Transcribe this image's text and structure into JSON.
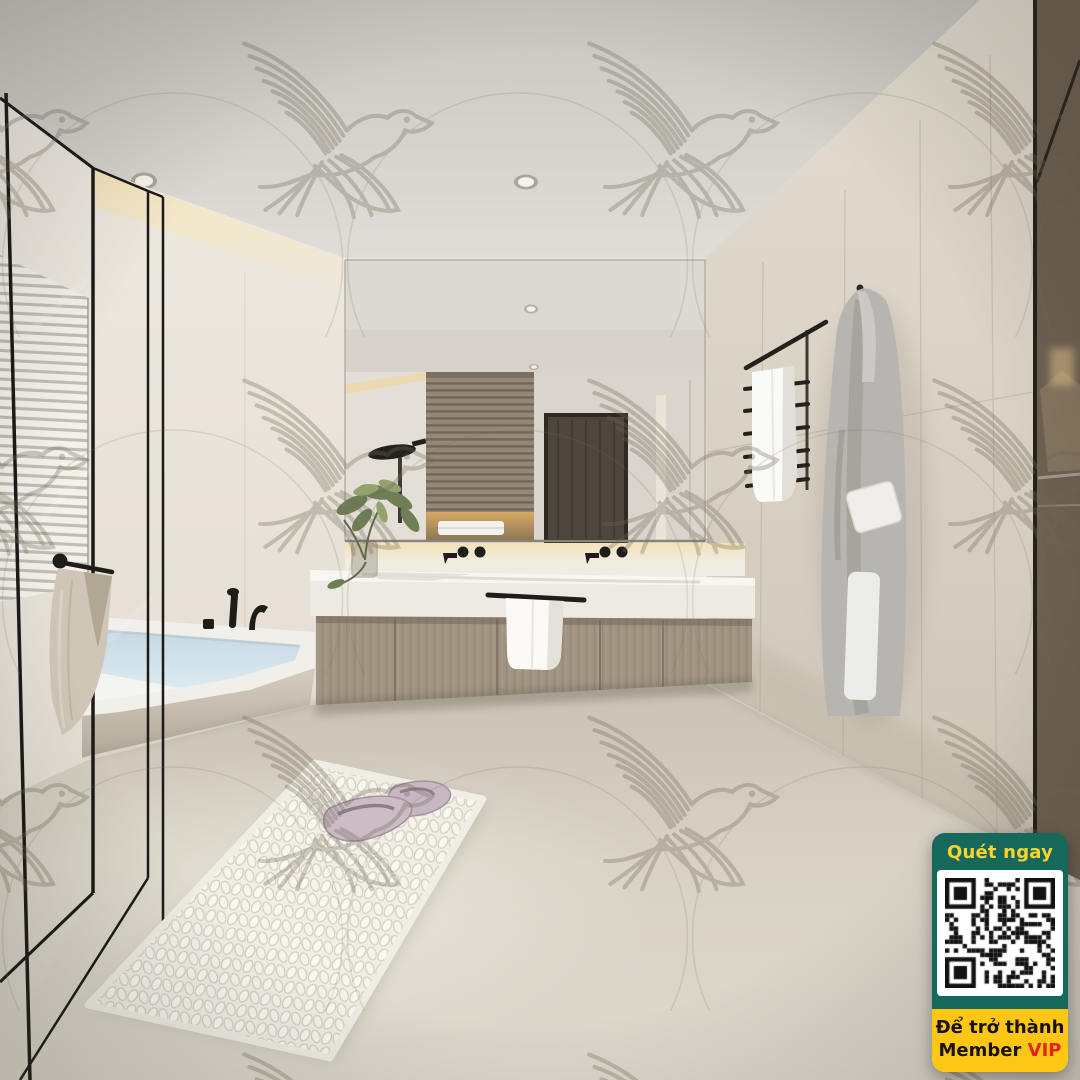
{
  "image": {
    "kind": "bathroom-interior-3d-render",
    "width": 1080,
    "height": 1080
  },
  "watermark": {
    "motif": "flying-dove-line-art",
    "secondary_motif": "interlocking-circle-arcs",
    "stroke_color": "#77705f"
  },
  "palette": {
    "ceiling": "#d6d3cd",
    "back_wall": "#ece8e1",
    "left_wall": "#e9e4dc",
    "right_wall_tile": "#d8d1c4",
    "floor": "#d8d2c7",
    "vanity_wood": "#9d9180",
    "counter_stone": "#efece5",
    "bath_water": "#cfdfe8",
    "bronze_glass": "#6e6152",
    "fixture_black": "#22201c",
    "cove_light": "#f6e3b4"
  },
  "qr_badge": {
    "scan_label": "Quét ngay",
    "footer_line1": "Để trở thành",
    "footer_member": "Member",
    "footer_vip": "VIP",
    "colors": {
      "green": "#16695a",
      "yellow": "#ffc713",
      "scan_text": "#ffd22e",
      "footer_text": "#161310",
      "vip": "#e6231b",
      "qr_dark": "#121212",
      "qr_light": "#ffffff"
    }
  }
}
